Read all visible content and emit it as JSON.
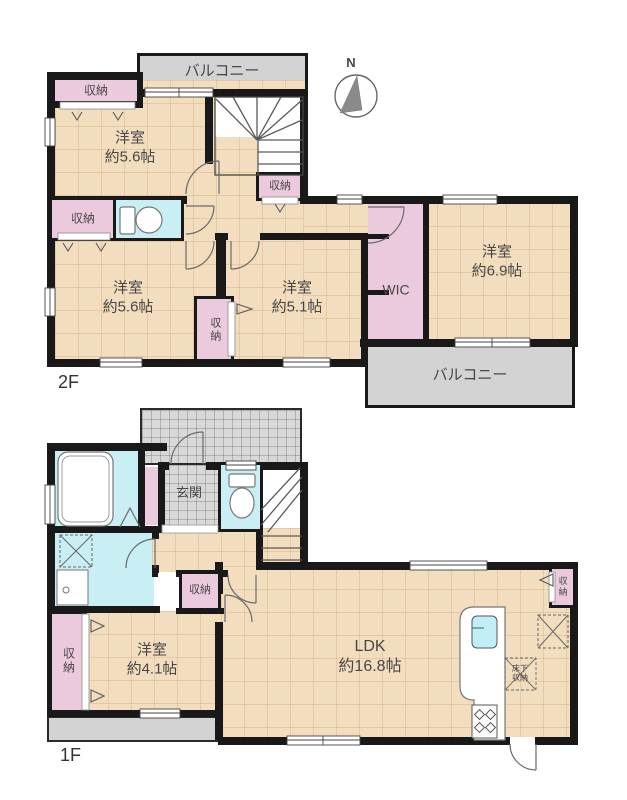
{
  "compass": {
    "label": "N"
  },
  "floor2": {
    "label": "2F",
    "balcony_top": "バルコニー",
    "balcony_bottom": "バルコニー",
    "closet_top_left": "収納",
    "closet_left": "収納",
    "closet_stair": "収納",
    "closet_mid": "収納",
    "room_nw": {
      "name": "洋室",
      "size": "約5.6帖"
    },
    "room_sw": {
      "name": "洋室",
      "size": "約5.6帖"
    },
    "room_s": {
      "name": "洋室",
      "size": "約5.1帖"
    },
    "room_e": {
      "name": "洋室",
      "size": "約6.9帖"
    },
    "wic": "WIC"
  },
  "floor1": {
    "label": "1F",
    "entrance": "玄関",
    "closet_hall": "収納",
    "closet_bedroom": "収納",
    "closet_ldk": "収納",
    "room_sw": {
      "name": "洋室",
      "size": "約4.1帖"
    },
    "ldk": {
      "name": "LDK",
      "size": "約16.8帖"
    },
    "floor_storage": "床下収納"
  },
  "colors": {
    "floor_tan": "#f3ddbf",
    "closet_pink": "#eccade",
    "wet_cyan": "#c9eff5",
    "balcony_gray": "#d3d3d3",
    "wall": "#191919"
  }
}
